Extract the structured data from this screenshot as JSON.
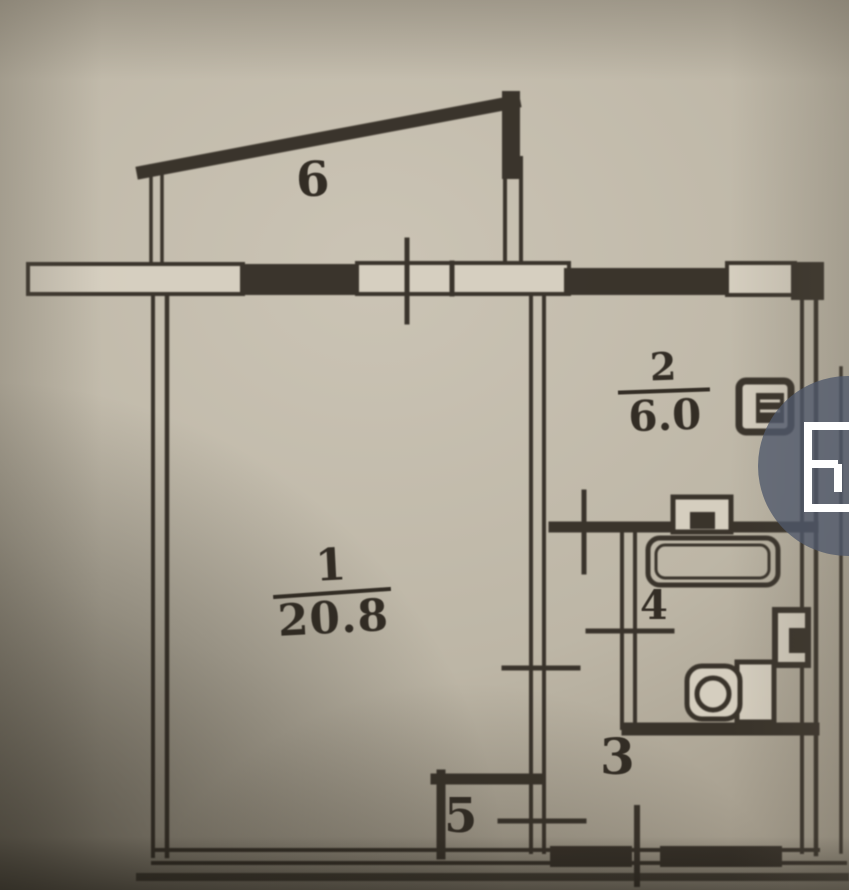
{
  "plan": {
    "rooms": [
      {
        "key": "balcony",
        "number": "6",
        "area": ""
      },
      {
        "key": "living-room",
        "number": "1",
        "area": "20.8"
      },
      {
        "key": "kitchen",
        "number": "2",
        "area": "6.0"
      },
      {
        "key": "bathroom",
        "number": "4",
        "area": ""
      },
      {
        "key": "hallway",
        "number": "3",
        "area": ""
      },
      {
        "key": "closet",
        "number": "5",
        "area": ""
      }
    ],
    "colors": {
      "paper": "#bdb6a6",
      "ink": "#332d25",
      "window_fill": "#d7d0c1",
      "overlay_circle": "rgba(80,89,108,0.78)",
      "icon_white": "#ffffff"
    }
  },
  "overlay": {
    "button": {
      "icon": "floorplan-icon"
    }
  }
}
